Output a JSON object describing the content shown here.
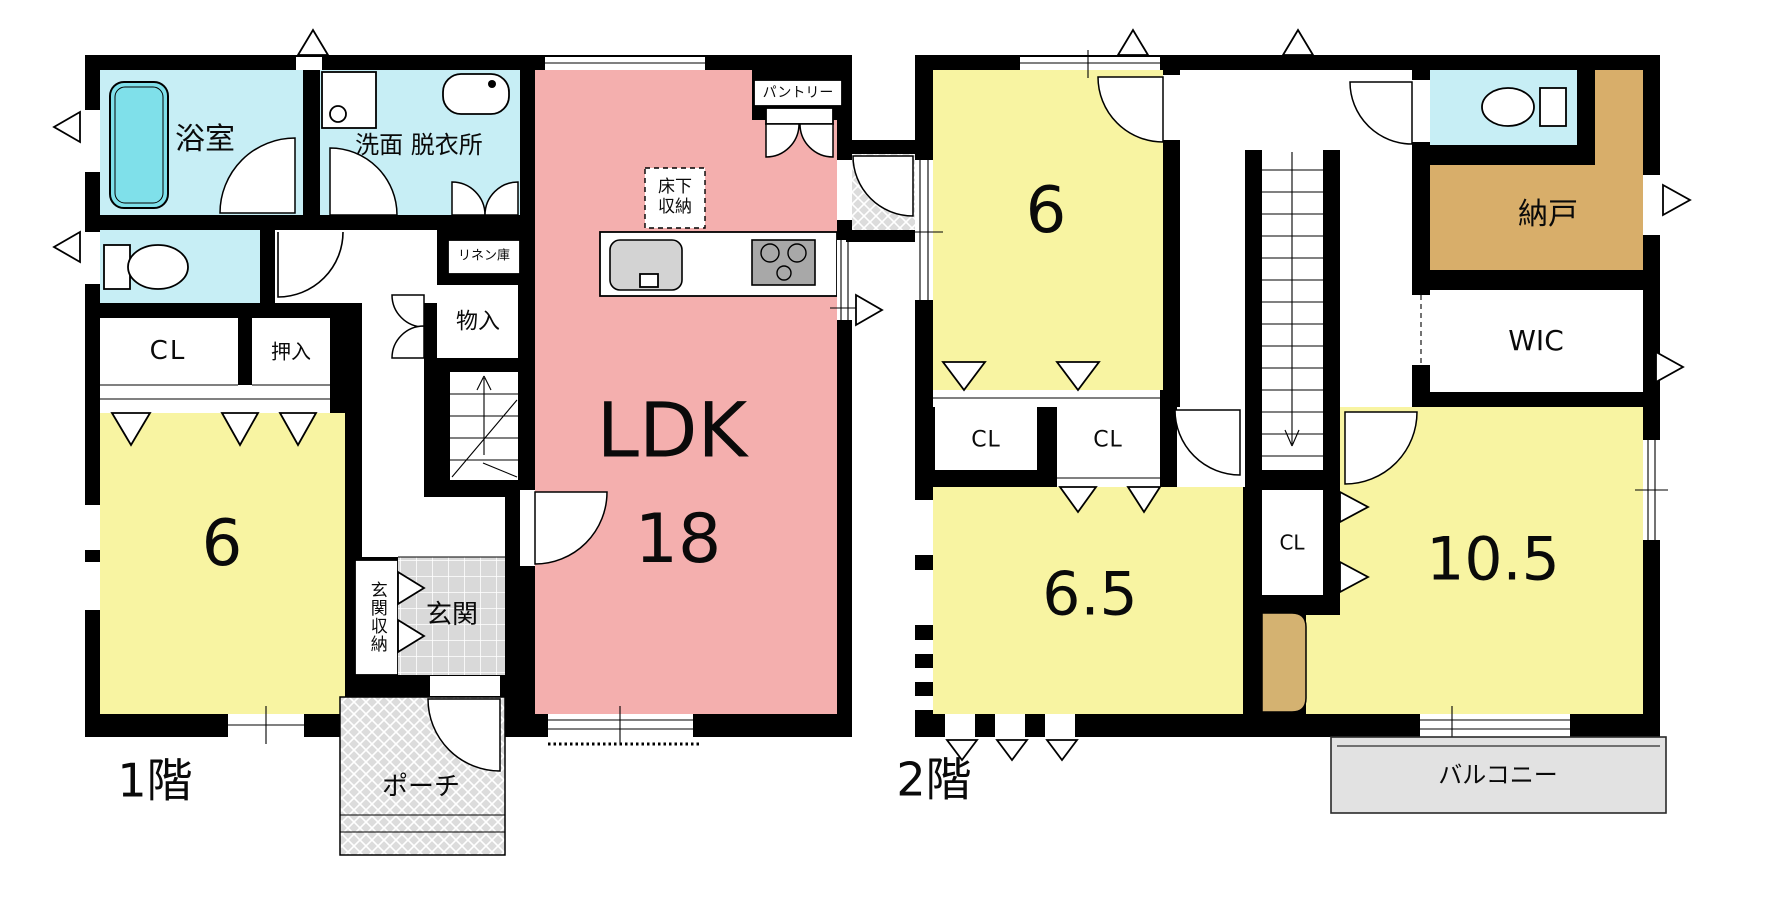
{
  "document": {
    "type": "floor-plan"
  },
  "floor1": {
    "title": "1階",
    "rooms": {
      "bathroom": "浴室",
      "washroom": "洗面 脱衣所",
      "linen": "リネン庫",
      "storage": "物入",
      "closet": "CL",
      "oshiire": "押入",
      "bedroom_size": "6",
      "ldk_label": "LDK",
      "ldk_size": "18",
      "underfloor_line1": "床下",
      "underfloor_line2": "収納",
      "pantry": "パントリー",
      "entrance_storage": "玄関収納",
      "entrance": "玄関",
      "porch": "ポーチ"
    }
  },
  "floor2": {
    "title": "2階",
    "rooms": {
      "bedroom1_size": "6",
      "closet1": "CL",
      "closet2": "CL",
      "bedroom2_size": "6.5",
      "closet3": "CL",
      "storage_room": "納戸",
      "walk_in_closet": "WIC",
      "bedroom3_size": "10.5",
      "balcony": "バルコニー"
    }
  },
  "colors": {
    "wall": "#000000",
    "room_yellow": "#f8f4a2",
    "room_pink": "#f4afae",
    "room_cyan": "#c7eef5",
    "tub": "#7fe0ea",
    "tan": "#d8ae6a",
    "desk": "#d4b271",
    "tile": "#d9d9d9",
    "porch": "#dcdcdc",
    "balcony": "#e2e2e2",
    "counter": "#d3d3d3",
    "stove": "#a8a8a8"
  }
}
